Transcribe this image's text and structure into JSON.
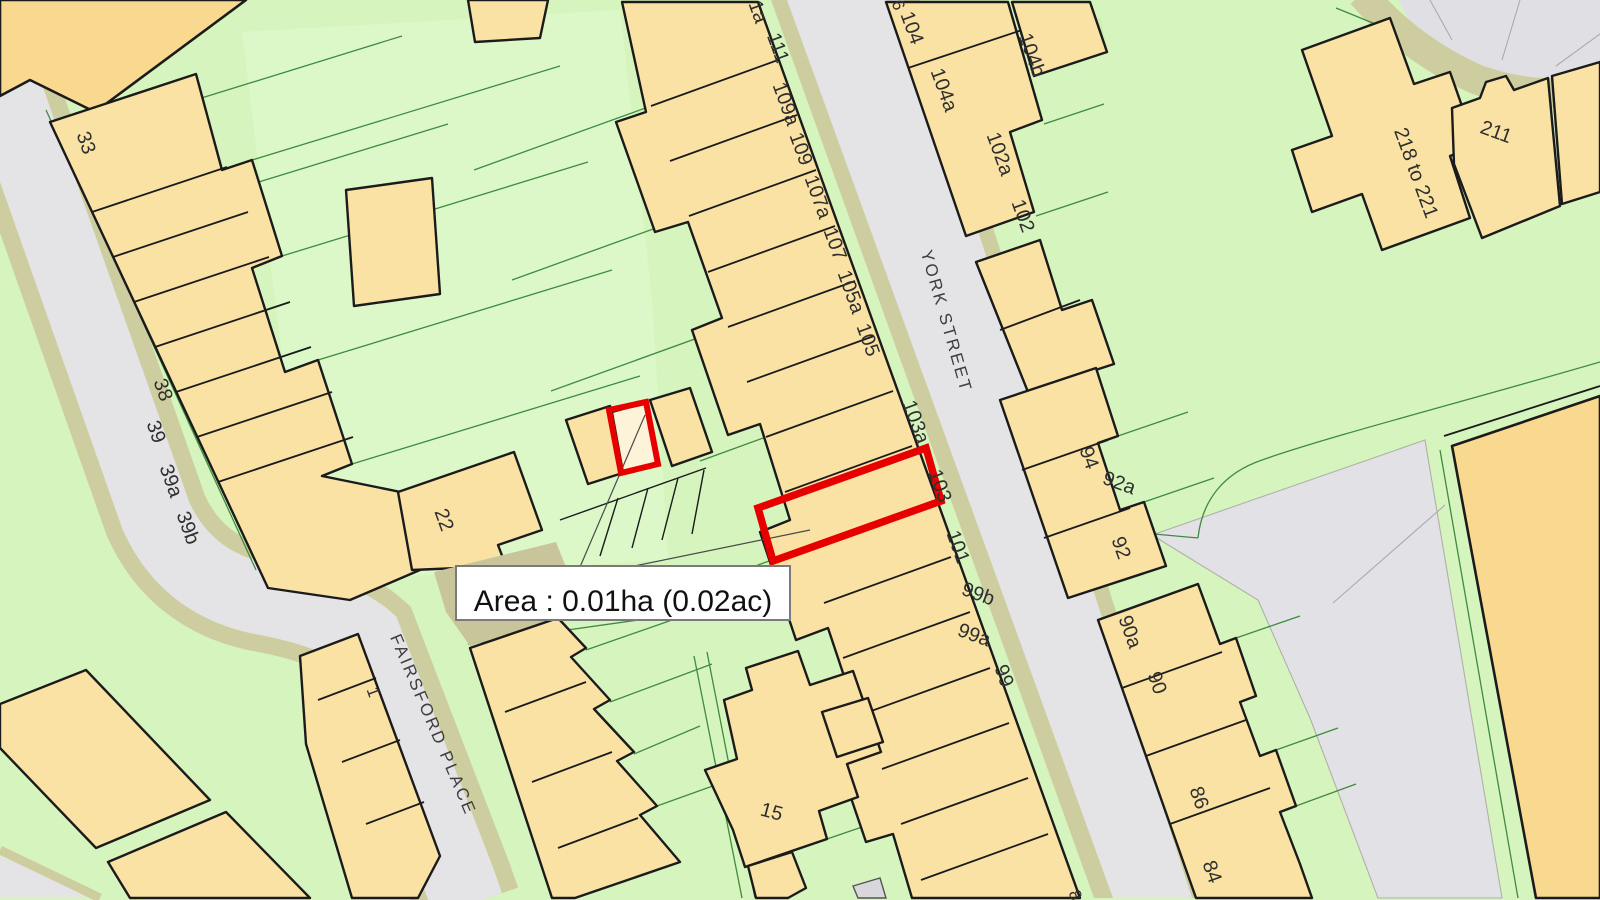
{
  "area_box": {
    "text": "Area : 0.01ha (0.02ac)"
  },
  "streets": {
    "york": "YORK STREET",
    "fairsford": "FAIRSFORD PLACE"
  },
  "labels": [
    {
      "text": "33"
    },
    {
      "text": "38"
    },
    {
      "text": "39"
    },
    {
      "text": "39a"
    },
    {
      "text": "39b"
    },
    {
      "text": "1a"
    },
    {
      "text": "111"
    },
    {
      "text": "109a"
    },
    {
      "text": "109"
    },
    {
      "text": "107a"
    },
    {
      "text": "107"
    },
    {
      "text": "105a"
    },
    {
      "text": "105"
    },
    {
      "text": "103a"
    },
    {
      "text": "103"
    },
    {
      "text": "101"
    },
    {
      "text": "99b"
    },
    {
      "text": "99a"
    },
    {
      "text": "99"
    },
    {
      "text": "8"
    },
    {
      "text": "6"
    },
    {
      "text": "104"
    },
    {
      "text": "104a"
    },
    {
      "text": "104b"
    },
    {
      "text": "102a"
    },
    {
      "text": "102"
    },
    {
      "text": "94"
    },
    {
      "text": "92a"
    },
    {
      "text": "92"
    },
    {
      "text": "90a"
    },
    {
      "text": "90"
    },
    {
      "text": "86"
    },
    {
      "text": "84"
    },
    {
      "text": "211"
    },
    {
      "text": "218 to 221"
    },
    {
      "text": "22"
    },
    {
      "text": "1"
    },
    {
      "text": "15"
    }
  ],
  "highlight": {
    "plot": "103",
    "color": "#e60000"
  },
  "colors": {
    "building": "#fae2a4",
    "building_deep": "#f9d98f",
    "grass": "#d6f4bd",
    "grass_light": "#dcf8c9",
    "road": "#e4e4e7",
    "kerb": "#cdcda0",
    "boundary": "#3f8b3f",
    "outline": "#1b1b1b"
  }
}
